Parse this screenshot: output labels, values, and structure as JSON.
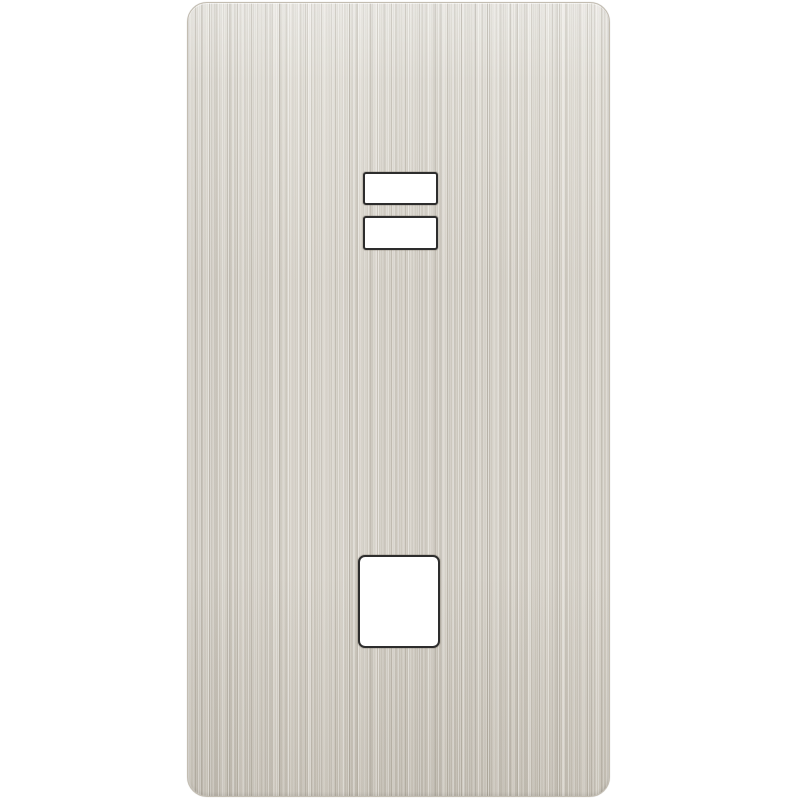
{
  "scene": {
    "background_color": "#ffffff",
    "description": "Product photo of a brushed stainless/nickel finish wall switch plate with two horizontal rocker cutouts near the top and one square cutout near the bottom, centered on a plain white background"
  },
  "plate": {
    "finish": "brushed-metal-vertical-grain",
    "base_color": "#d8d3c9",
    "highlight_color": "#e7e4dc",
    "shadow_color": "#cfc9bd",
    "edge_color": "#c3bdb1",
    "left": 187,
    "top": 2,
    "width": 423,
    "height": 795,
    "corner_radius": 20
  },
  "cutouts": [
    {
      "label": "upper-rocker-opening",
      "left": 363,
      "top": 172,
      "width": 75,
      "height": 33,
      "radius": 3,
      "border_color": "#2d2d2d",
      "fill": "#ffffff"
    },
    {
      "label": "lower-rocker-opening",
      "left": 363,
      "top": 216,
      "width": 75,
      "height": 34,
      "radius": 3,
      "border_color": "#2d2d2d",
      "fill": "#ffffff"
    },
    {
      "label": "square-opening",
      "left": 358,
      "top": 555,
      "width": 82,
      "height": 93,
      "radius": 7,
      "border_color": "#2d2d2d",
      "fill": "#ffffff"
    }
  ]
}
